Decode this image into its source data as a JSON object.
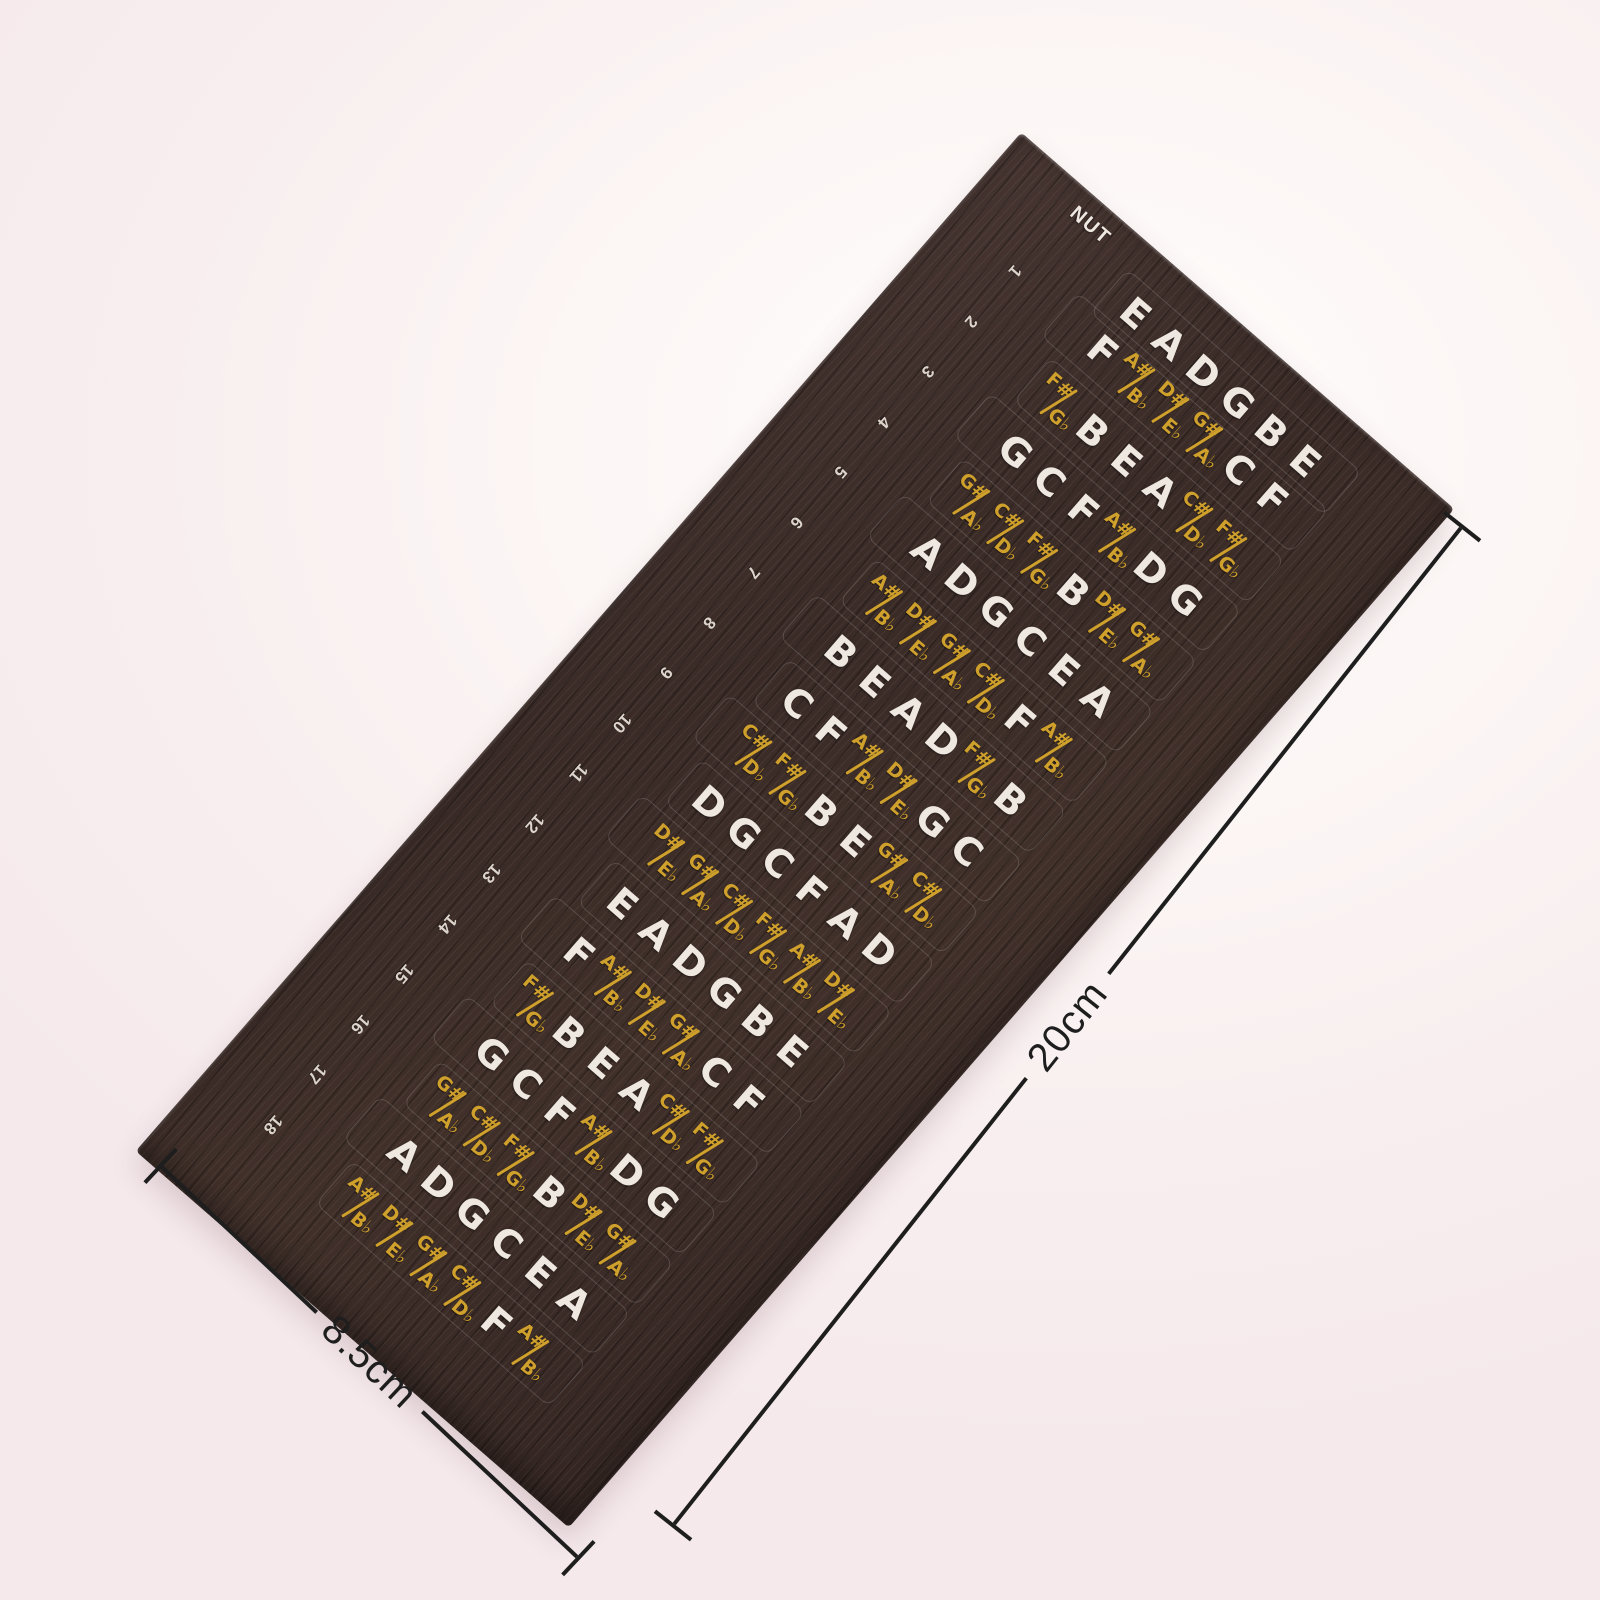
{
  "sheet": {
    "nut_label": "NUT",
    "fret_numbers": [
      "1",
      "2",
      "3",
      "4",
      "5",
      "6",
      "7",
      "8",
      "9",
      "10",
      "11",
      "12",
      "13",
      "14",
      "15",
      "16",
      "17",
      "18"
    ],
    "rows": [
      {
        "fret": 0,
        "notes": [
          {
            "n": "E"
          },
          {
            "n": "A"
          },
          {
            "n": "D"
          },
          {
            "n": "G"
          },
          {
            "n": "B"
          },
          {
            "n": "E"
          }
        ]
      },
      {
        "fret": 1,
        "notes": [
          {
            "n": "F"
          },
          {
            "s": "A#",
            "f": "B♭"
          },
          {
            "s": "D#",
            "f": "E♭"
          },
          {
            "s": "G#",
            "f": "A♭"
          },
          {
            "n": "C"
          },
          {
            "n": "F"
          }
        ]
      },
      {
        "fret": 2,
        "notes": [
          {
            "s": "F#",
            "f": "G♭"
          },
          {
            "n": "B"
          },
          {
            "n": "E"
          },
          {
            "n": "A"
          },
          {
            "s": "C#",
            "f": "D♭"
          },
          {
            "s": "F#",
            "f": "G♭"
          }
        ]
      },
      {
        "fret": 3,
        "notes": [
          {
            "n": "G"
          },
          {
            "n": "C"
          },
          {
            "n": "F"
          },
          {
            "s": "A#",
            "f": "B♭"
          },
          {
            "n": "D"
          },
          {
            "n": "G"
          }
        ]
      },
      {
        "fret": 4,
        "notes": [
          {
            "s": "G#",
            "f": "A♭"
          },
          {
            "s": "C#",
            "f": "D♭"
          },
          {
            "s": "F#",
            "f": "G♭"
          },
          {
            "n": "B"
          },
          {
            "s": "D#",
            "f": "E♭"
          },
          {
            "s": "G#",
            "f": "A♭"
          }
        ]
      },
      {
        "fret": 5,
        "notes": [
          {
            "n": "A"
          },
          {
            "n": "D"
          },
          {
            "n": "G"
          },
          {
            "n": "C"
          },
          {
            "n": "E"
          },
          {
            "n": "A"
          }
        ]
      },
      {
        "fret": 6,
        "notes": [
          {
            "s": "A#",
            "f": "B♭"
          },
          {
            "s": "D#",
            "f": "E♭"
          },
          {
            "s": "G#",
            "f": "A♭"
          },
          {
            "s": "C#",
            "f": "D♭"
          },
          {
            "n": "F"
          },
          {
            "s": "A#",
            "f": "B♭"
          }
        ]
      },
      {
        "fret": 7,
        "notes": [
          {
            "n": "B"
          },
          {
            "n": "E"
          },
          {
            "n": "A"
          },
          {
            "n": "D"
          },
          {
            "s": "F#",
            "f": "G♭"
          },
          {
            "n": "B"
          }
        ]
      },
      {
        "fret": 8,
        "notes": [
          {
            "n": "C"
          },
          {
            "n": "F"
          },
          {
            "s": "A#",
            "f": "B♭"
          },
          {
            "s": "D#",
            "f": "E♭"
          },
          {
            "n": "G"
          },
          {
            "n": "C"
          }
        ]
      },
      {
        "fret": 9,
        "notes": [
          {
            "s": "C#",
            "f": "D♭"
          },
          {
            "s": "F#",
            "f": "G♭"
          },
          {
            "n": "B"
          },
          {
            "n": "E"
          },
          {
            "s": "G#",
            "f": "A♭"
          },
          {
            "s": "C#",
            "f": "D♭"
          }
        ]
      },
      {
        "fret": 10,
        "notes": [
          {
            "n": "D"
          },
          {
            "n": "G"
          },
          {
            "n": "C"
          },
          {
            "n": "F"
          },
          {
            "n": "A"
          },
          {
            "n": "D"
          }
        ]
      },
      {
        "fret": 11,
        "notes": [
          {
            "s": "D#",
            "f": "E♭"
          },
          {
            "s": "G#",
            "f": "A♭"
          },
          {
            "s": "C#",
            "f": "D♭"
          },
          {
            "s": "F#",
            "f": "G♭"
          },
          {
            "s": "A#",
            "f": "B♭"
          },
          {
            "s": "D#",
            "f": "E♭"
          }
        ]
      },
      {
        "fret": 12,
        "notes": [
          {
            "n": "E"
          },
          {
            "n": "A"
          },
          {
            "n": "D"
          },
          {
            "n": "G"
          },
          {
            "n": "B"
          },
          {
            "n": "E"
          }
        ]
      },
      {
        "fret": 13,
        "notes": [
          {
            "n": "F"
          },
          {
            "s": "A#",
            "f": "B♭"
          },
          {
            "s": "D#",
            "f": "E♭"
          },
          {
            "s": "G#",
            "f": "A♭"
          },
          {
            "n": "C"
          },
          {
            "n": "F"
          }
        ]
      },
      {
        "fret": 14,
        "notes": [
          {
            "s": "F#",
            "f": "G♭"
          },
          {
            "n": "B"
          },
          {
            "n": "E"
          },
          {
            "n": "A"
          },
          {
            "s": "C#",
            "f": "D♭"
          },
          {
            "s": "F#",
            "f": "G♭"
          }
        ]
      },
      {
        "fret": 15,
        "notes": [
          {
            "n": "G"
          },
          {
            "n": "C"
          },
          {
            "n": "F"
          },
          {
            "s": "A#",
            "f": "B♭"
          },
          {
            "n": "D"
          },
          {
            "n": "G"
          }
        ]
      },
      {
        "fret": 16,
        "notes": [
          {
            "s": "G#",
            "f": "A♭"
          },
          {
            "s": "C#",
            "f": "D♭"
          },
          {
            "s": "F#",
            "f": "G♭"
          },
          {
            "n": "B"
          },
          {
            "s": "D#",
            "f": "E♭"
          },
          {
            "s": "G#",
            "f": "A♭"
          }
        ]
      },
      {
        "fret": 17,
        "notes": [
          {
            "n": "A"
          },
          {
            "n": "D"
          },
          {
            "n": "G"
          },
          {
            "n": "C"
          },
          {
            "n": "E"
          },
          {
            "n": "A"
          }
        ]
      },
      {
        "fret": 18,
        "notes": [
          {
            "s": "A#",
            "f": "B♭"
          },
          {
            "s": "D#",
            "f": "E♭"
          },
          {
            "s": "G#",
            "f": "A♭"
          },
          {
            "s": "C#",
            "f": "D♭"
          },
          {
            "n": "F"
          },
          {
            "s": "A#",
            "f": "B♭"
          }
        ]
      }
    ],
    "colors": {
      "sheet": "#3a2b27",
      "natural_note": "#efe8e0",
      "accidental_note": "#cfa02c",
      "dimension_line": "#1e1e1e",
      "backdrop": "#f8eeef"
    }
  },
  "dimensions": {
    "length_label": "20cm",
    "width_label": "8.5cm"
  }
}
